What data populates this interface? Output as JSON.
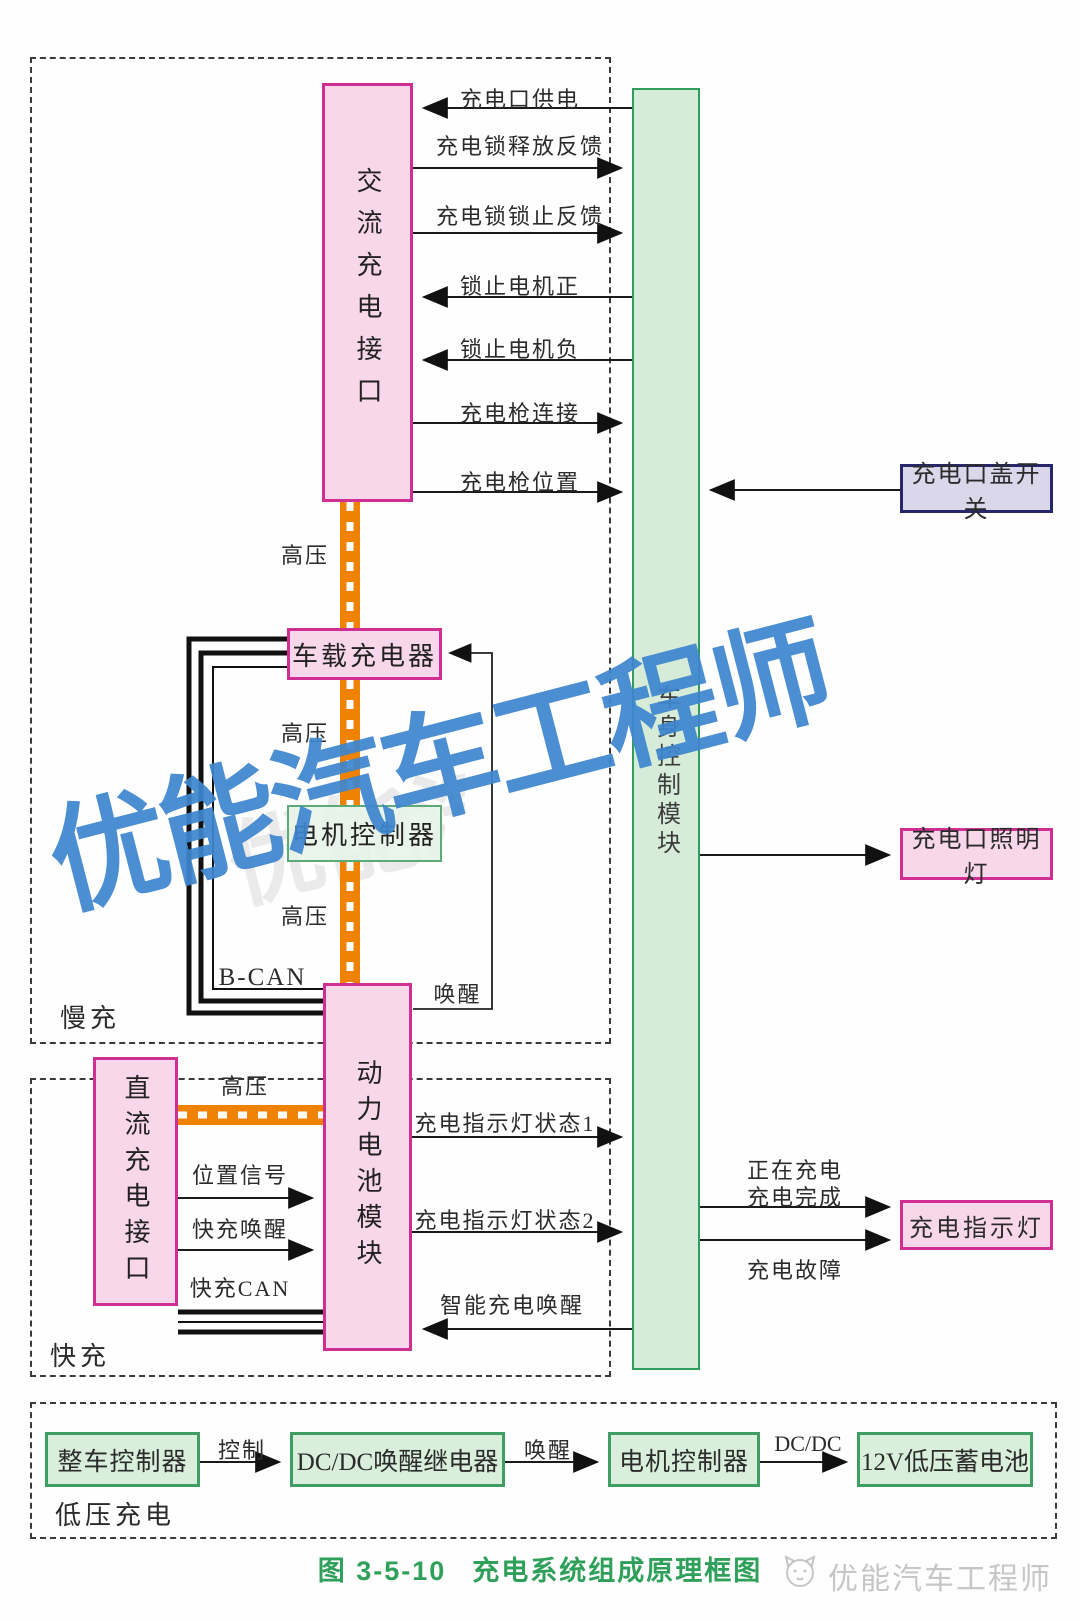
{
  "caption": {
    "figure_no": "图 3-5-10",
    "title": "充电系统组成原理框图"
  },
  "watermark": {
    "text": "优能汽车工程师"
  },
  "footer_logo": {
    "text": "优能汽车工程师",
    "icon": "cat-logo-icon"
  },
  "sections": {
    "slow": {
      "label": "慢充"
    },
    "fast": {
      "label": "快充"
    },
    "low_voltage": {
      "label": "低压充电"
    }
  },
  "blocks": {
    "ac_charge_port": "交流充电接口",
    "onboard_charger": "车载充电器",
    "motor_controller_mid": "电机控制器",
    "power_battery_module": "动力电池模块",
    "dc_charge_port": "直流充电接口",
    "body_control_module": "车身控制模块",
    "charge_port_cover_switch": "充电口盖开关",
    "charge_port_lamp": "充电口照明灯",
    "charge_indicator_lamp": "充电指示灯",
    "vehicle_controller": "整车控制器",
    "dcdc_wake_relay": "DC/DC唤醒继电器",
    "motor_controller_low": "电机控制器",
    "battery_12v": "12V低压蓄电池"
  },
  "signals": {
    "port_power": "充电口供电",
    "lock_release_feedback": "充电锁释放反馈",
    "lock_locked_feedback": "充电锁锁止反馈",
    "lock_motor_positive": "锁止电机正",
    "lock_motor_negative": "锁止电机负",
    "gun_connect": "充电枪连接",
    "gun_position": "充电枪位置",
    "high_voltage": "高压",
    "b_can": "B-CAN",
    "wake": "唤醒",
    "indicator_status1": "充电指示灯状态1",
    "indicator_status2": "充电指示灯状态2",
    "smart_charge_wake": "智能充电唤醒",
    "position_signal": "位置信号",
    "fast_charge_wake": "快充唤醒",
    "fast_charge_can": "快充CAN",
    "charging_now": "正在充电",
    "charging_done": "充电完成",
    "charging_fault": "充电故障",
    "control": "控制",
    "dcdc": "DC/DC"
  },
  "colors": {
    "pink_fill": "#f8d7eb",
    "pink_border": "#cf2f92",
    "green_fill": "#d6ecd8",
    "green_border": "#2f9e5d",
    "lavender_fill": "#d9d7e9",
    "lavender_border": "#26266b",
    "hv_orange": "#ef8200",
    "caption_green": "#2fa05a",
    "watermark_blue": "#3e86cf"
  }
}
